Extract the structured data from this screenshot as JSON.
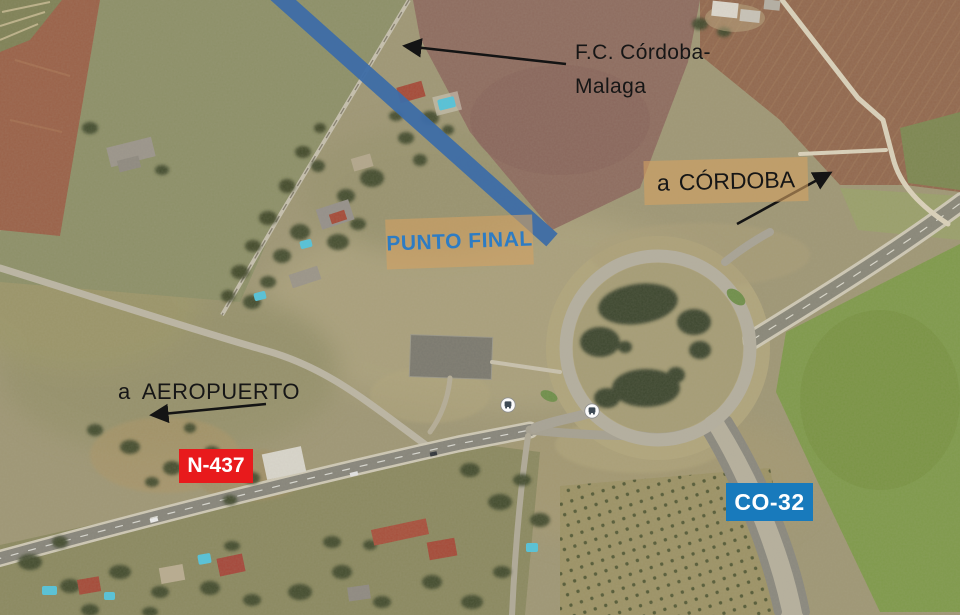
{
  "annotations": {
    "railway": {
      "line1": "F.C. Córdoba-",
      "line2": "Malaga"
    },
    "cordoba": {
      "prefix": "a",
      "label": "CÓRDOBA"
    },
    "punto_final": {
      "label": "PUNTO FINAL"
    },
    "aeropuerto": {
      "prefix": "a",
      "label": "AEROPUERTO"
    },
    "n437": {
      "label": "N-437"
    },
    "co32": {
      "label": "CO-32"
    }
  },
  "colors": {
    "railway_overlay": "#3e6da7",
    "n437_bg": "#e81a1c",
    "co32_bg": "#187abc",
    "punto_text": "#2e7cc3",
    "annotation_text": "#161616",
    "highlight_box": "rgba(211,162,99,0.6)"
  },
  "icons": {
    "bus_stop": "bus-stop-icon"
  }
}
